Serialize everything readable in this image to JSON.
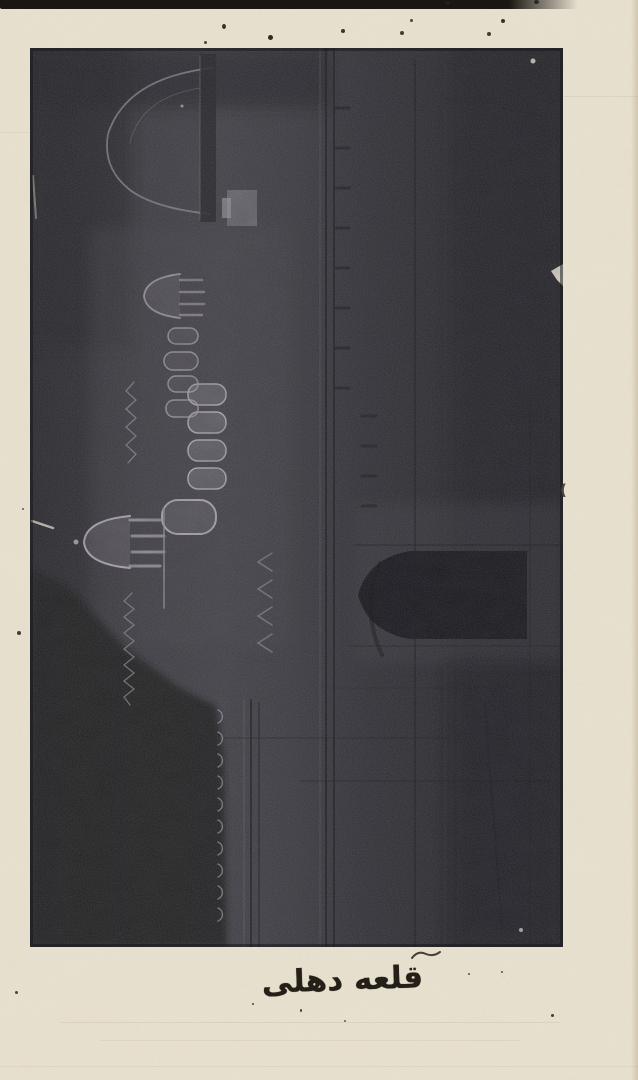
{
  "page": {
    "caption": "قلعه دهلی",
    "margin_mark": "(",
    "colors": {
      "paper": "#e9e2d1",
      "plate": "#2e2d32",
      "ink": "#241f17"
    },
    "photo": {
      "alt": "Dark halftone photograph plate, rotated 90 degrees, showing the Delhi Fort: domes, minaret, arcaded pavilions (chhatris), battlemented walls and a pointed-arch gateway"
    }
  }
}
